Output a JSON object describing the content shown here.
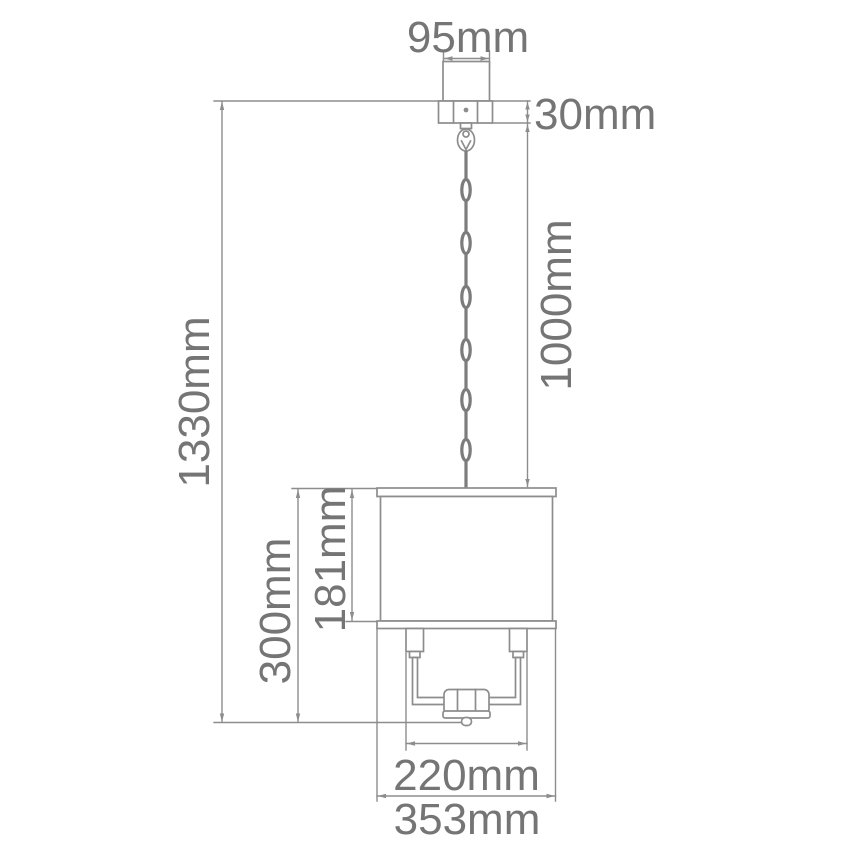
{
  "diagram": {
    "subject": "pendant-light-dimension-drawing",
    "unit": "mm"
  },
  "dimensions": {
    "canopy_width": {
      "label": "95mm",
      "value_mm": 95
    },
    "canopy_height": {
      "label": "30mm",
      "value_mm": 30
    },
    "overall_drop": {
      "label": "1330mm",
      "value_mm": 1330
    },
    "chain_length": {
      "label": "1000mm",
      "value_mm": 1000
    },
    "body_height": {
      "label": "300mm",
      "value_mm": 300
    },
    "shade_height": {
      "label": "181mm",
      "value_mm": 181
    },
    "frame_width": {
      "label": "220mm",
      "value_mm": 220
    },
    "shade_width": {
      "label": "353mm",
      "value_mm": 353
    }
  },
  "colors": {
    "line": "#8d8d8d",
    "text": "#757575",
    "background": "#ffffff"
  }
}
